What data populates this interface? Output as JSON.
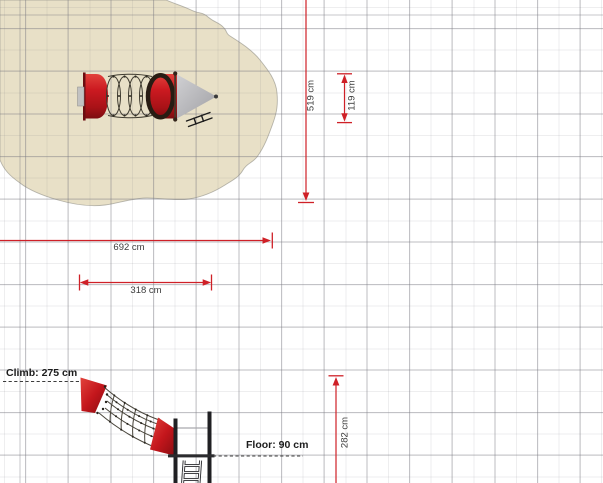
{
  "canvas": {
    "dimension_labels": {
      "area_height": "519 cm",
      "equipment_depth": "119 cm",
      "area_width": "692 cm",
      "equipment_width": "318 cm",
      "total_height": "282 cm"
    },
    "annotations": {
      "climb_height": "Climb: 275 cm",
      "floor_height": "Floor: 90 cm"
    },
    "colors": {
      "dimension_line": "#cf2027",
      "safety_surface": "#e8e0c7",
      "equipment_red": "#c9191f",
      "roof_gray": "#b4b4b7",
      "frame_black": "#202023",
      "grid_major": "#c5c5c8",
      "annotation_text": "#1c1c1c",
      "dimension_text": "#3c3c3c"
    }
  }
}
